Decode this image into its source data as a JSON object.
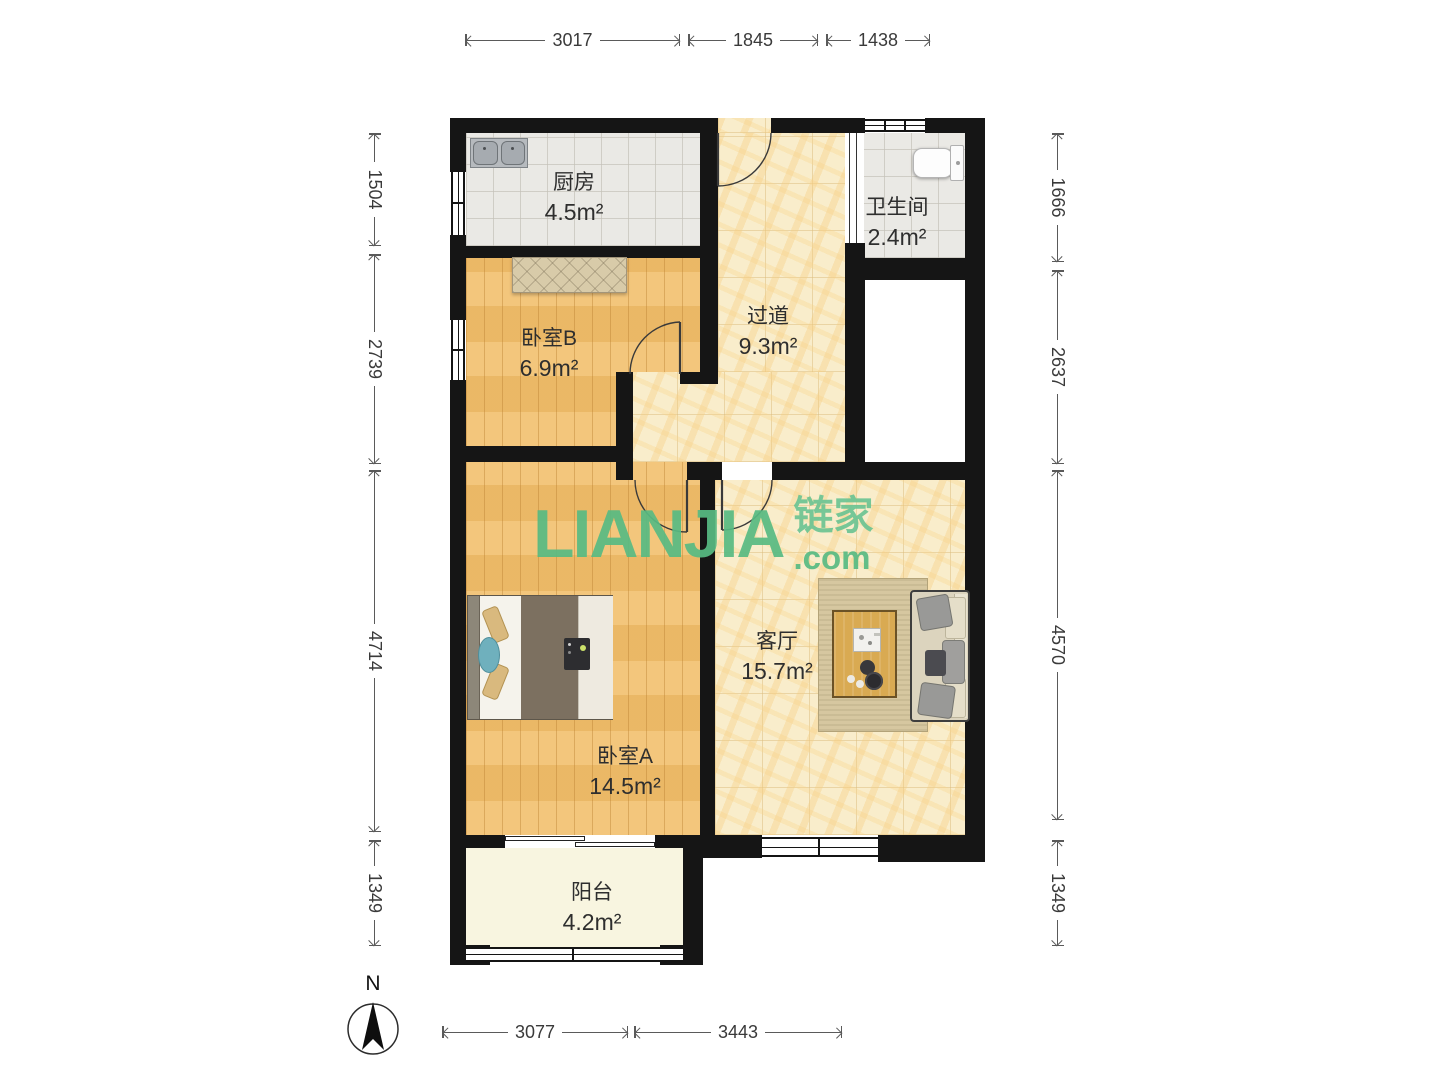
{
  "watermark": {
    "brand": "LIANJIA",
    "cn": "链家",
    "tld": ".com"
  },
  "compass": {
    "label": "N"
  },
  "rooms": [
    {
      "id": "kitchen",
      "name": "厨房",
      "area": "4.5m²"
    },
    {
      "id": "bathroom",
      "name": "卫生间",
      "area": "2.4m²"
    },
    {
      "id": "hallway",
      "name": "过道",
      "area": "9.3m²"
    },
    {
      "id": "bedroomB",
      "name": "卧室B",
      "area": "6.9m²"
    },
    {
      "id": "livingroom",
      "name": "客厅",
      "area": "15.7m²"
    },
    {
      "id": "bedroomA",
      "name": "卧室A",
      "area": "14.5m²"
    },
    {
      "id": "balcony",
      "name": "阳台",
      "area": "4.2m²"
    }
  ],
  "dimensions": {
    "top": [
      "3017",
      "1845",
      "1438"
    ],
    "left": [
      "1504",
      "2739",
      "4714",
      "1349"
    ],
    "right": [
      "1666",
      "2637",
      "4570",
      "1349"
    ],
    "bottom": [
      "3077",
      "3443"
    ]
  },
  "colors": {
    "wall": "#151515",
    "watermark_green": "#58bb83",
    "wood_floor": "#f2c06d",
    "marble_floor": "#f8ebc4",
    "tile_floor": "#eae9e5"
  }
}
